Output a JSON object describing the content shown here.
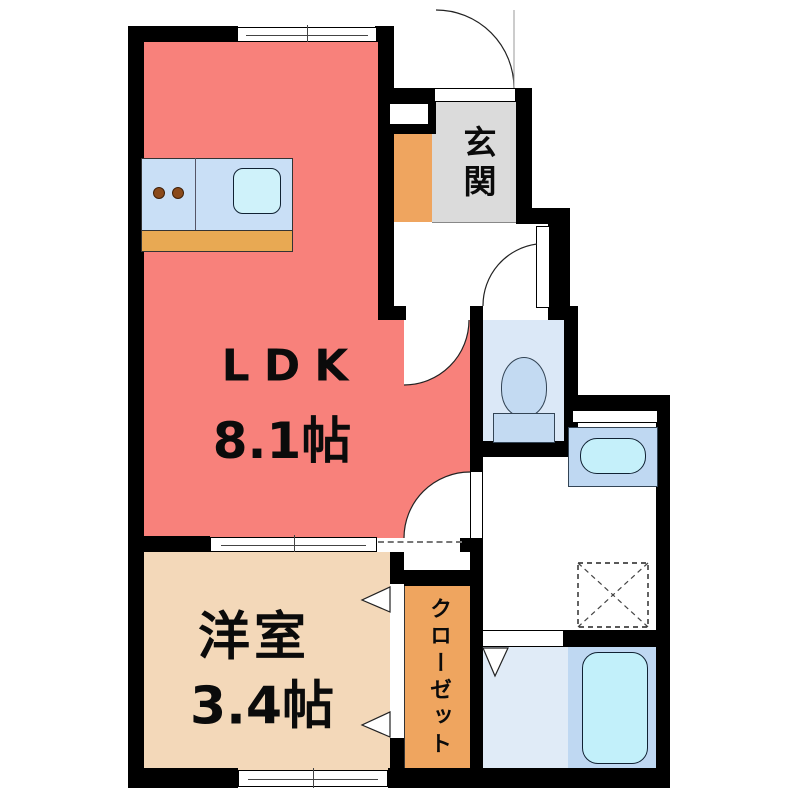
{
  "plan": {
    "type": "apartment-floorplan",
    "rooms": {
      "ldk": {
        "label": "LDK",
        "size": "8.1帖"
      },
      "western": {
        "label": "洋室",
        "size": "3.4帖"
      },
      "entrance": {
        "label": "玄関"
      },
      "closet": {
        "label": "クローゼット"
      }
    },
    "fixtures": [
      "kitchen-counter",
      "kitchen-sink",
      "stove-burners",
      "toilet",
      "washbasin",
      "washing-machine-space",
      "bathtub",
      "entrance-door",
      "toilet-door",
      "ldk-doors",
      "closet-folding-doors",
      "bath-folding-door",
      "windows"
    ],
    "colors": {
      "wall": "#000000",
      "ldk": "#F8817B",
      "western_room": "#F3D8B9",
      "closet_orange": "#EFA55F",
      "entrance_gray": "#DBDBDB",
      "toilet_room_blue": "#DBE8F7",
      "fixture_blue": "#C3DAF2",
      "counter_blue": "#C9DFF6",
      "water_cyan": "#C5F0FA",
      "bath_section_blue": "#BFD8F2",
      "bath_floor_blue": "#E0EBF7",
      "counter_base_orange": "#E8A953"
    }
  }
}
